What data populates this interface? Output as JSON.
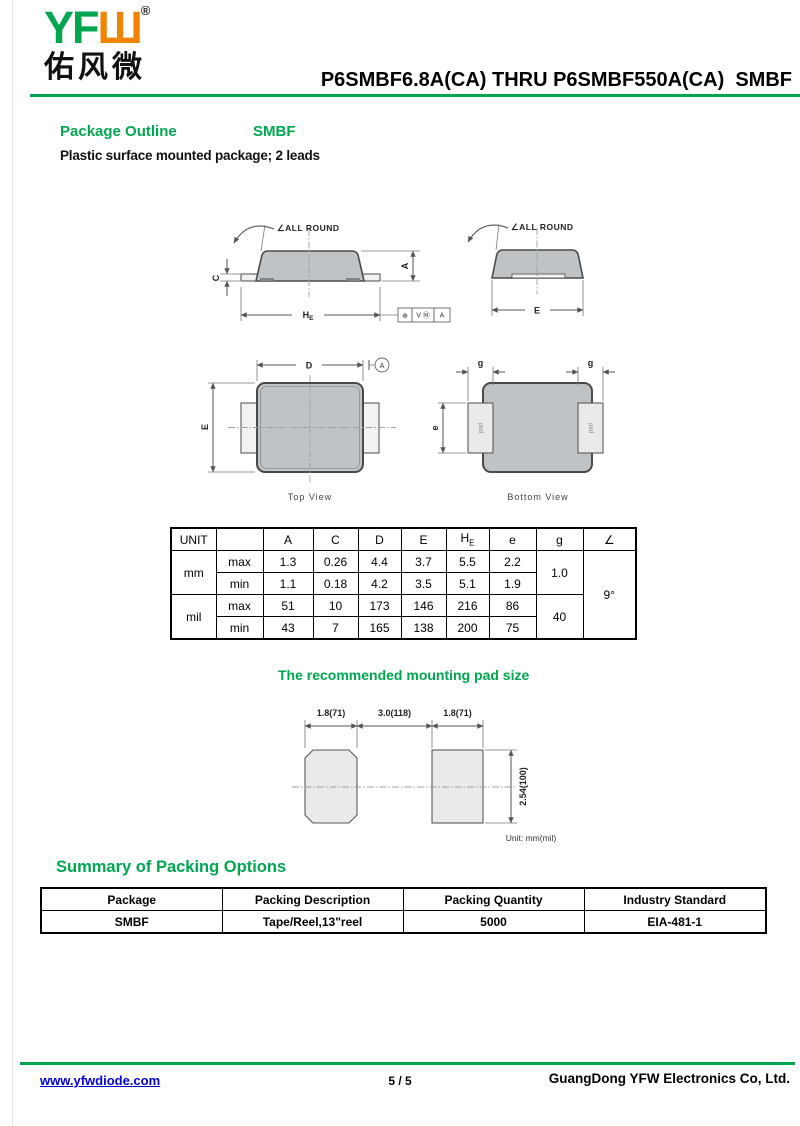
{
  "colors": {
    "green": "#00A551",
    "orange": "#F08300",
    "link_blue": "#0000CC",
    "body_gray": "#BFC3C6",
    "pad_gray": "#E9EAEA"
  },
  "header": {
    "logo_latin": "YF",
    "logo_w": "Ш",
    "registered": "®",
    "logo_cn": "佑风微",
    "title": "P6SMBF6.8A(CA) THRU P6SMBF550A(CA)  SMBF"
  },
  "section": {
    "heading": "Package Outline",
    "package_name": "SMBF",
    "description": "Plastic surface mounted package; 2 leads"
  },
  "drawing": {
    "all_round": "∠ALL ROUND",
    "dim_c": "C",
    "dim_a": "A",
    "he_main": "H",
    "he_sub": "E",
    "dim_e": "E",
    "dim_d": "D",
    "datum_a": "A",
    "dim_g": "g",
    "dim_e_lower": "e",
    "pad_label": "pad",
    "top_view": "Top View",
    "bottom_view": "Bottom View",
    "fcf": {
      "sym": "⊕",
      "tol": "V Ⓜ",
      "datum": "A"
    }
  },
  "dim_table": {
    "unit_header": "UNIT",
    "headers": {
      "a": "A",
      "c": "C",
      "d": "D",
      "e": "E",
      "he_main": "H",
      "he_sub": "E",
      "e_lower": "e",
      "g": "g",
      "angle": "∠"
    },
    "row_labels": {
      "mm": "mm",
      "mil": "mil",
      "max": "max",
      "min": "min"
    },
    "mm_max": [
      "1.3",
      "0.26",
      "4.4",
      "3.7",
      "5.5",
      "2.2"
    ],
    "mm_min": [
      "1.1",
      "0.18",
      "4.2",
      "3.5",
      "5.1",
      "1.9"
    ],
    "mil_max": [
      "51",
      "10",
      "173",
      "146",
      "216",
      "86"
    ],
    "mil_min": [
      "43",
      "7",
      "165",
      "138",
      "200",
      "75"
    ],
    "g_mm": "1.0",
    "g_mil": "40",
    "angle_value": "9°"
  },
  "pad_drawing": {
    "title": "The recommended mounting pad size",
    "dim_left": "1.8(71)",
    "dim_center": "3.0(118)",
    "dim_right": "1.8(71)",
    "dim_height": "2.54(100)",
    "unit_note": "Unit: mm(mil)"
  },
  "packing": {
    "heading": "Summary of Packing Options",
    "headers": [
      "Package",
      "Packing Description",
      "Packing Quantity",
      "Industry Standard"
    ],
    "row": [
      "SMBF",
      "Tape/Reel,13\"reel",
      "5000",
      "EIA-481-1"
    ]
  },
  "footer": {
    "website": "www.yfwdiode.com",
    "page_number": "5 / 5",
    "company": "GuangDong YFW Electronics Co, Ltd."
  }
}
